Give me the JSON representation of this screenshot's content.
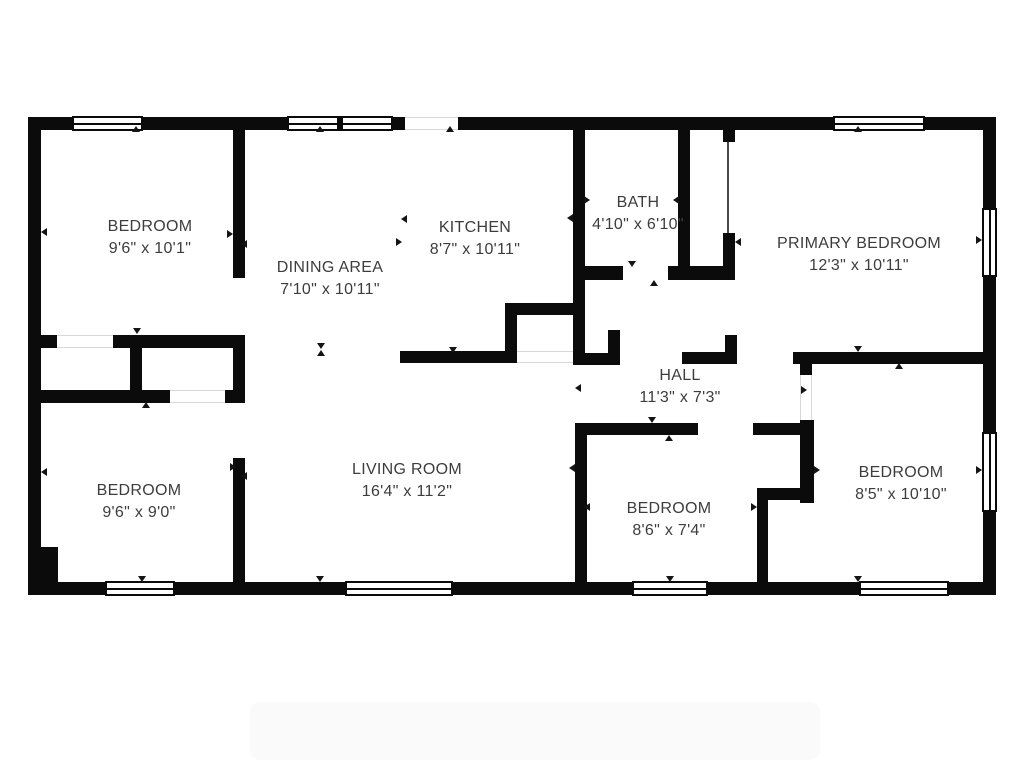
{
  "plan": {
    "type": "residential-floor-plan",
    "wall_color": "#0b0b0b",
    "text_color": "#3d3d3d",
    "background": "#ffffff",
    "opening_line_color": "#d8d8d8"
  },
  "rooms": [
    {
      "name": "BEDROOM",
      "dims": "9'6\" x 10'1\""
    },
    {
      "name": "DINING AREA",
      "dims": "7'10\" x 10'11\""
    },
    {
      "name": "KITCHEN",
      "dims": "8'7\" x 10'11\""
    },
    {
      "name": "BATH",
      "dims": "4'10\" x 6'10\""
    },
    {
      "name": "PRIMARY BEDROOM",
      "dims": "12'3\" x 10'11\""
    },
    {
      "name": "HALL",
      "dims": "11'3\" x 7'3\""
    },
    {
      "name": "BEDROOM",
      "dims": "9'6\" x 9'0\""
    },
    {
      "name": "LIVING ROOM",
      "dims": "16'4\" x 11'2\""
    },
    {
      "name": "BEDROOM",
      "dims": "8'6\" x 7'4\""
    },
    {
      "name": "BEDROOM",
      "dims": "8'5\" x 10'10\""
    }
  ]
}
